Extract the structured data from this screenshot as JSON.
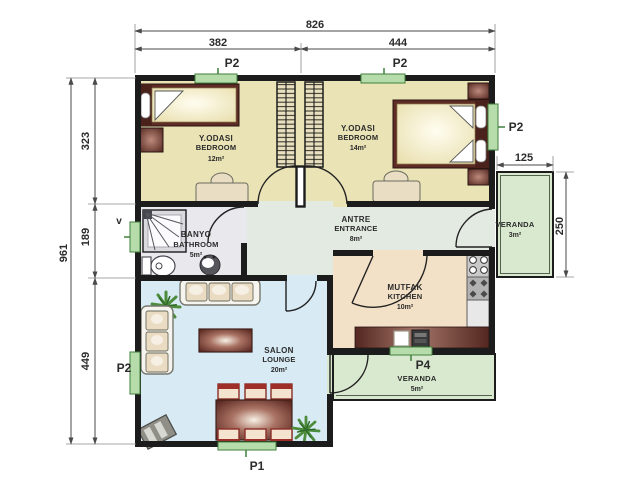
{
  "dimensions": {
    "total_width": "826",
    "width_left": "382",
    "width_right": "444",
    "total_height": "961",
    "height_top": "323",
    "height_middle": "189",
    "height_bottom": "449",
    "veranda_east_width": "125",
    "veranda_east_height": "250"
  },
  "rooms": {
    "bedroom1": {
      "name": "Y.ODASI",
      "name_en": "BEDROOM",
      "area": "12m²"
    },
    "bedroom2": {
      "name": "Y.ODASI",
      "name_en": "BEDROOM",
      "area": "14m²"
    },
    "bathroom": {
      "name": "BANYO",
      "name_en": "BATHROOM",
      "area": "5m²"
    },
    "entrance": {
      "name": "ANTRE",
      "name_en": "ENTRANCE",
      "area": "8m²"
    },
    "kitchen": {
      "name": "MUTFAK",
      "name_en": "KITCHEN",
      "area": "10m²"
    },
    "lounge": {
      "name": "SALON",
      "name_en": "LOUNGE",
      "area": "20m²"
    },
    "veranda_east": {
      "name": "VERANDA",
      "area": "3m²"
    },
    "veranda_south": {
      "name": "VERANDA",
      "area": "5m²"
    }
  },
  "openings": {
    "window_top_left": "P2",
    "window_top_right": "P2",
    "window_east": "P2",
    "window_lounge_west": "P2",
    "door_south": "P1",
    "window_kitchen_south": "P4",
    "window_bath": "v"
  },
  "colors": {
    "wall": "#1c1c1c",
    "bedroom_floor": "#eae3b6",
    "bathroom_floor": "#e8e8ed",
    "entrance_floor": "#e3eae2",
    "lounge_floor": "#d8ebf4",
    "kitchen_floor": "#f3e1c7",
    "veranda_floor": "#d9e9cf",
    "window_fill": "#b7dcab",
    "window_border": "#3f7f3a",
    "furniture_wood": "#5f2c25"
  }
}
